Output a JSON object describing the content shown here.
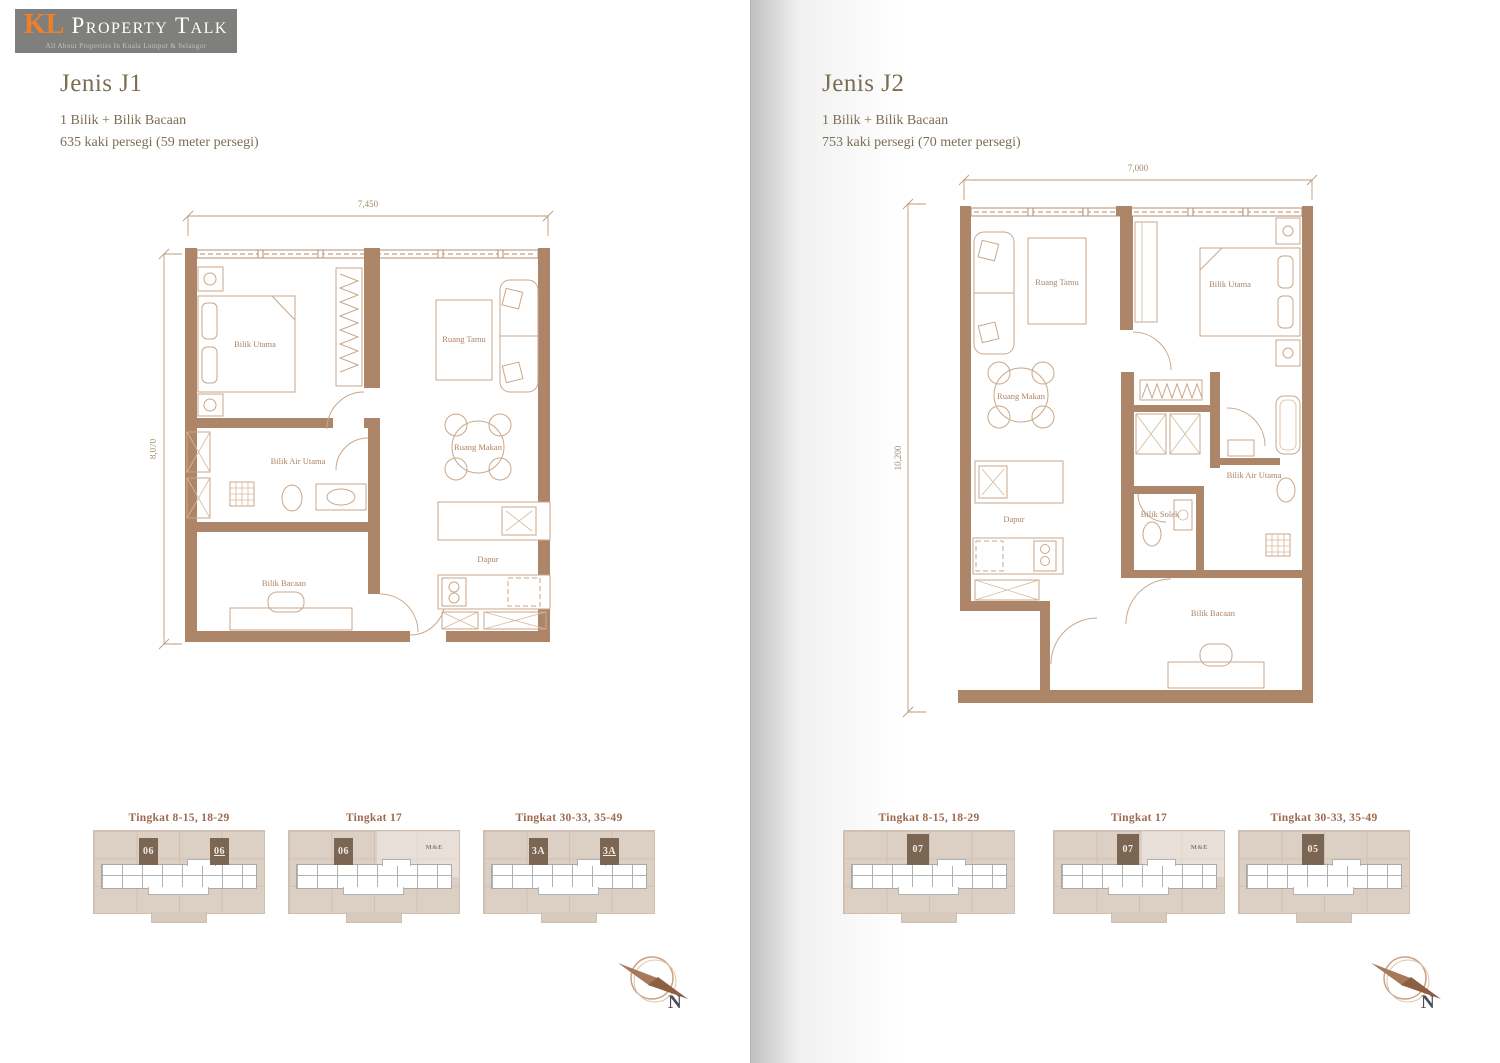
{
  "logo": {
    "kl": "KL",
    "name": "Property Talk",
    "tagline": "All About Properties In Kuala Lumpur & Selangor"
  },
  "colors": {
    "wall_brown": "#ad8669",
    "furniture_tan": "#c9a789",
    "title_olive": "#7b6e52",
    "keyplan_title_brown": "#9e6a4e",
    "keyplan_bg_tan": "#dccfc3",
    "highlight_unit_brown": "#7b6553",
    "logo_orange": "#f08027",
    "logo_gray": "#7f7f7e"
  },
  "left_page": {
    "title": "Jenis J1",
    "subtitle": "1 Bilik + Bilik Bacaan",
    "area": "635 kaki persegi (59 meter persegi)",
    "plan": {
      "dim_top": "7,450",
      "dim_left": "8,070",
      "rooms": {
        "bilik_utama": "Bilik Utama",
        "ruang_tamu": "Ruang Tamu",
        "ruang_makan": "Ruang Makan",
        "bilik_air_utama": "Bilik Air Utama",
        "bilik_bacaan": "Bilik Bacaan",
        "dapur": "Dapur"
      }
    },
    "keyplans": [
      {
        "title": "Tingkat 8-15, 18-29",
        "units": [
          "06",
          "06"
        ]
      },
      {
        "title": "Tingkat 17",
        "units": [
          "06"
        ],
        "me": "M&E"
      },
      {
        "title": "Tingkat 30-33, 35-49",
        "units": [
          "3A",
          "3A"
        ]
      }
    ],
    "compass": "N"
  },
  "right_page": {
    "title": "Jenis J2",
    "subtitle": "1 Bilik + Bilik Bacaan",
    "area": "753 kaki persegi (70 meter persegi)",
    "plan": {
      "dim_top": "7,000",
      "dim_left": "10,200",
      "rooms": {
        "ruang_tamu": "Ruang Tamu",
        "bilik_utama": "Bilik Utama",
        "ruang_makan": "Ruang Makan",
        "bilik_air_utama": "Bilik Air Utama",
        "bilik_solek": "Bilik Solek",
        "dapur": "Dapur",
        "bilik_bacaan": "Bilik Bacaan"
      }
    },
    "keyplans": [
      {
        "title": "Tingkat 8-15, 18-29",
        "units": [
          "07"
        ]
      },
      {
        "title": "Tingkat 17",
        "units": [
          "07"
        ],
        "me": "M&E"
      },
      {
        "title": "Tingkat 30-33, 35-49",
        "units": [
          "05"
        ]
      }
    ],
    "compass": "N"
  }
}
